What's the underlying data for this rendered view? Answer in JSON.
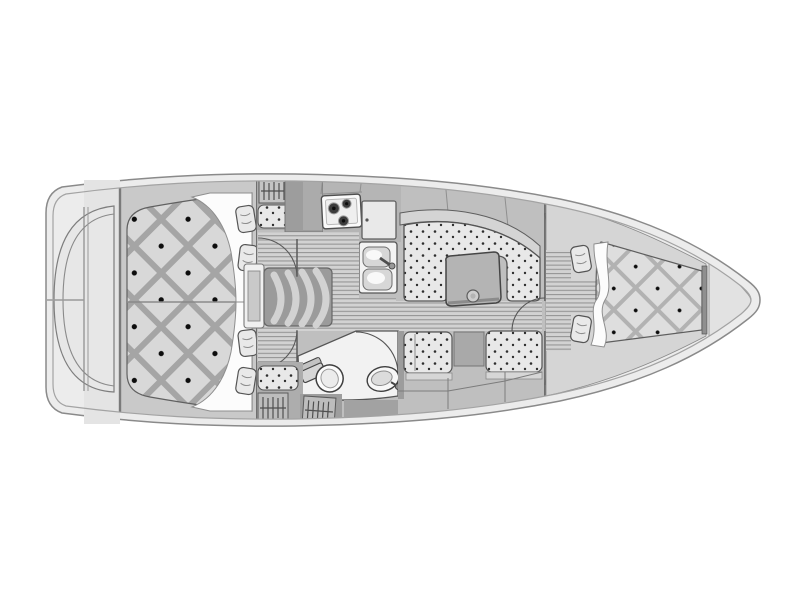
{
  "image": {
    "type": "sailboat-interior-floor-plan",
    "background": "#ffffff",
    "orientation": {
      "stern": "left",
      "bow": "right"
    }
  },
  "colors": {
    "background": "#ffffff",
    "hull_fill": "#ececec",
    "hull_stroke": "#8a8a8a",
    "hull_inner_stroke": "#a3a3a3",
    "transom_fill": "#e7e7e7",
    "platform_aft": "#c9c9c9",
    "deck_mid": "#bfbfbf",
    "deck_dark": "#a6a6a6",
    "block_dark": "#9d9d9d",
    "quilt_base": "#d8d8d8",
    "quilt_band": "#a5a5a5",
    "quilt_button": "#0d0d0d",
    "quilt_base_fwd": "#dedede",
    "quilt_band_fwd": "#b2b2b2",
    "floor_base": "#d2d2d2",
    "floor_line": "#969696",
    "cushion_base": "#e8e8e8",
    "cushion_dot": "#2e2e2e",
    "white_soft": "#fcfcfc",
    "room_floor": "#f2f2f2",
    "fixture_white": "#fafafa",
    "steps_dark": "#9b9b9b",
    "steps_band": "#d2d2d2",
    "table_fill": "#b4b4b4",
    "bench_light": "#d6d6d6",
    "counter_light": "#e9e9e9",
    "outline": "#555555"
  },
  "features": {
    "stern": {
      "swim_platform": true,
      "transom_rail_outlines": 2,
      "centerline_seam": true
    },
    "aft_cabin": {
      "berth": "double quilted berth",
      "pillows": 4,
      "blanket_folds": 2,
      "hatch_lockers": 3,
      "seat_cushions": 2
    },
    "companionway": {
      "steps": 4,
      "door_swing_arcs": 2
    },
    "galley": {
      "stove_burners": 3,
      "icebox_doors": 1,
      "sink_basins": 2,
      "faucets": 1
    },
    "salon": {
      "u_settee": true,
      "table": true,
      "cup_recess": 1,
      "lower_settee_cushions": 2,
      "center_cabinet": 1
    },
    "head": {
      "toilet": 1,
      "washbasin": 1,
      "door_swing_arcs": 1
    },
    "forward_cabin": {
      "berth": "v-berth quilted",
      "pillows": 2,
      "blanket_folds": 1,
      "hatch_lockers": 2,
      "door_swing_arcs": 1
    },
    "bow": {
      "anchor_locker_deck": true
    }
  }
}
